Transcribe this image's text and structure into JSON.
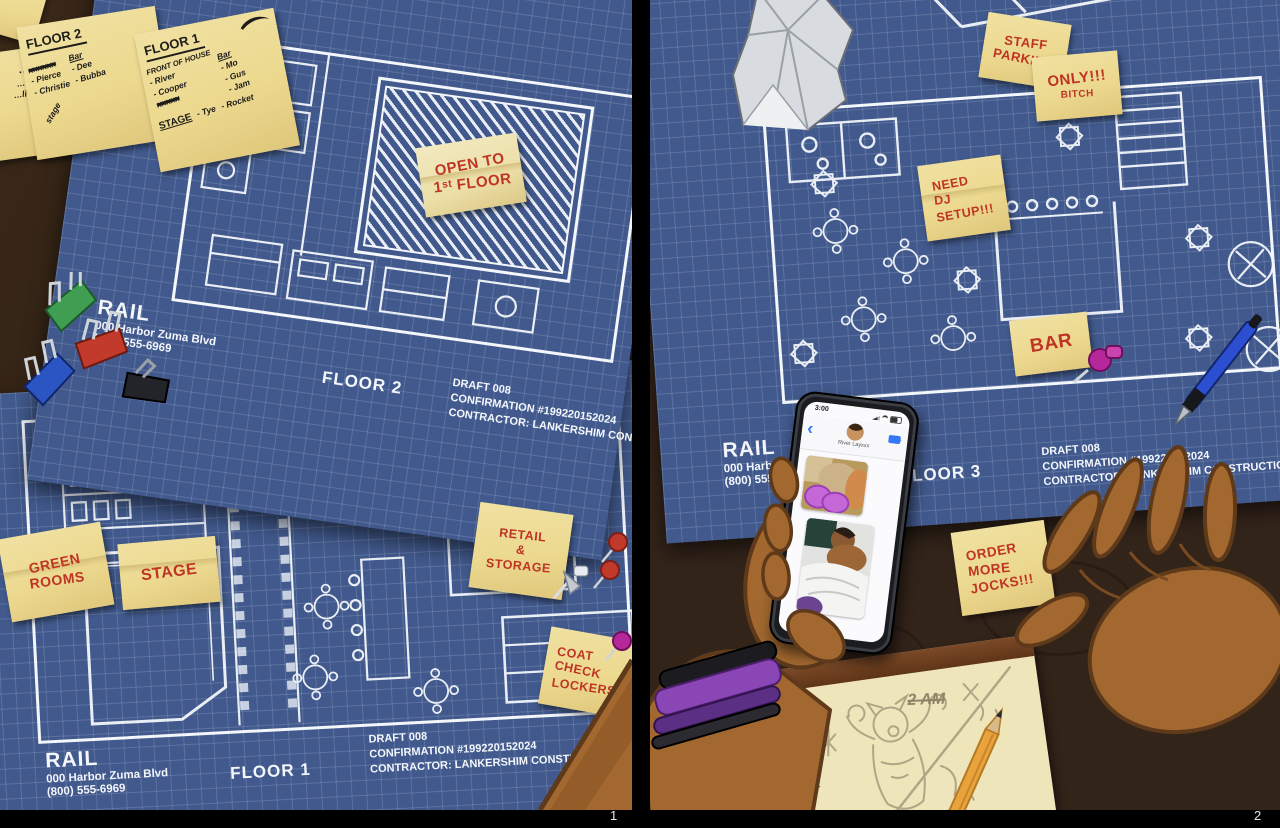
{
  "page": {
    "panel1_number": "1",
    "panel2_number": "2"
  },
  "colors": {
    "blueprint_blue": "#41598c",
    "blueprint_line": "#f3f6fb",
    "sticky_yellow": "#ecd98f",
    "marker_red": "#bf3425",
    "ink_black": "#1d1c1a",
    "wood_brown": "#3c2b1a",
    "skin_brown": "#a66a32",
    "phone_accent_blue": "#3478f6",
    "pencil_yellow": "#e8a33c"
  },
  "panel1": {
    "corner_scrap": "E",
    "cut_note_lines": [
      "…OOR",
      "…'s Cider",
      "…liquor lic"
    ],
    "floor2_note": {
      "title": "FLOOR 2",
      "list": [
        "xxxxxx",
        "- Pierce",
        "- Christie"
      ],
      "bar_title": "Bar",
      "bar_list": [
        "- Dee",
        "- Bubba"
      ],
      "side_scribble": "stage"
    },
    "floor1_note": {
      "title": "FLOOR 1",
      "foh_title": "FRONT OF HOUSE",
      "foh_list": [
        "- River",
        "- Cooper",
        "xxxxx"
      ],
      "bar_title": "Bar",
      "bar_list": [
        "- Mo",
        "- Gus",
        "- Jam"
      ],
      "stage_title": "STAGE",
      "stage_list": [
        "- Tye",
        "- Rocket"
      ]
    },
    "bp_floor2": {
      "brand": "RAIL",
      "address": "000 Harbor Zuma Blvd",
      "phone": "(800) 555-6969",
      "floor_label": "FLOOR 2",
      "draft": "DRAFT 008",
      "confirmation": "CONFIRMATION #199220152024",
      "contractor": "CONTRACTOR: LANKERSHIM CONSTRUCTION",
      "open_note": [
        "OPEN TO",
        "1ˢᵗ FLOOR"
      ]
    },
    "bp_floor1": {
      "brand": "RAIL",
      "address": "000 Harbor Zuma Blvd",
      "phone": "(800) 555-6969",
      "floor_label": "FLOOR 1",
      "draft": "DRAFT 008",
      "confirmation": "CONFIRMATION #199220152024",
      "contractor": "CONTRACTOR: LANKERSHIM CONSTRUCTION"
    },
    "green_rooms_note": [
      "GREEN",
      "ROOMS"
    ],
    "stage_note": [
      "STAGE"
    ],
    "retail_note": [
      "RETAIL",
      "&",
      "STORAGE"
    ],
    "coat_note": [
      "COAT",
      "CHECK",
      "LOCKERS"
    ]
  },
  "panel2": {
    "staff_parking_note": [
      "STAFF",
      "PARKING"
    ],
    "only_note": [
      "ONLY!!!",
      "BITCH"
    ],
    "dj_note": [
      "NEED",
      "DJ",
      "SETUP!!!"
    ],
    "bar_note": [
      "BAR"
    ],
    "jocks_note": [
      "ORDER",
      "MORE",
      "JOCKS!!!"
    ],
    "bp_floor3": {
      "brand": "RAIL",
      "address": "000 Harbor Zuma Blvd",
      "phone": "(800) 555-6969",
      "floor_label": "FLOOR 3",
      "draft": "DRAFT 008",
      "confirmation": "CONFIRMATION #199220152024",
      "contractor": "CONTRACTOR: LANKERSHIM CONSTRUCTION"
    },
    "phone": {
      "status_time": "3:00",
      "contact_name": "River Layxxx",
      "back_glyph": "‹"
    },
    "notepad": {
      "scribble": "2 AM"
    }
  }
}
